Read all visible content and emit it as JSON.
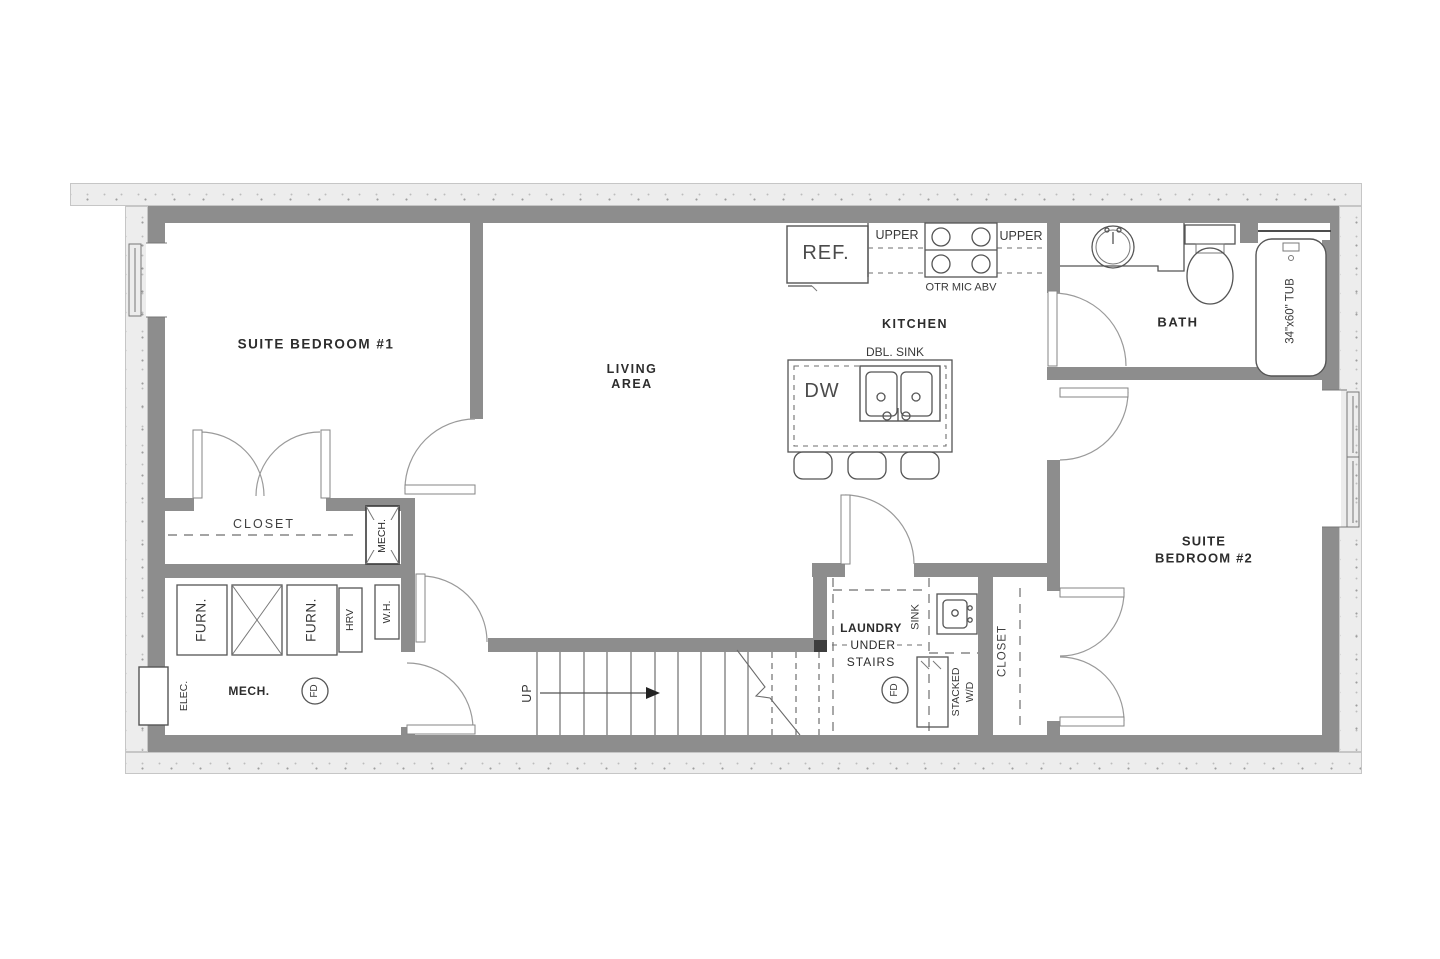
{
  "plan": {
    "rooms": {
      "bedroom1": "SUITE BEDROOM #1",
      "living1": "LIVING",
      "living2": "AREA",
      "kitchen": "KITCHEN",
      "bath": "BATH",
      "bedroom2_1": "SUITE",
      "bedroom2_2": "BEDROOM #2",
      "closet1": "CLOSET",
      "closet2": "CLOSET",
      "mech": "MECH.",
      "laundry1": "LAUNDRY",
      "laundry2": "UNDER",
      "laundry3": "STAIRS"
    },
    "kitchen_fixtures": {
      "ref": "REF.",
      "upper_left": "UPPER",
      "upper_right": "UPPER",
      "otr": "OTR MIC ABV",
      "dbl_sink": "DBL. SINK",
      "dw": "DW"
    },
    "bath_fixtures": {
      "tub": "34\"x60\" TUB"
    },
    "mech_fixtures": {
      "furn1": "FURN.",
      "furn2": "FURN.",
      "hrv": "HRV",
      "wh": "W.H.",
      "elec": "ELEC.",
      "fd": "FD",
      "chute": "MECH."
    },
    "laundry_fixtures": {
      "sink": "SINK",
      "stacked": "STACKED",
      "wd": "W/D",
      "fd": "FD"
    },
    "stairs": {
      "up": "UP",
      "tread_count": 13
    },
    "colors": {
      "wall": "#8d8d8d",
      "foundation": "#ededed",
      "line": "#555555",
      "arc": "#9a9a9a",
      "text": "#2d2d2d"
    }
  }
}
